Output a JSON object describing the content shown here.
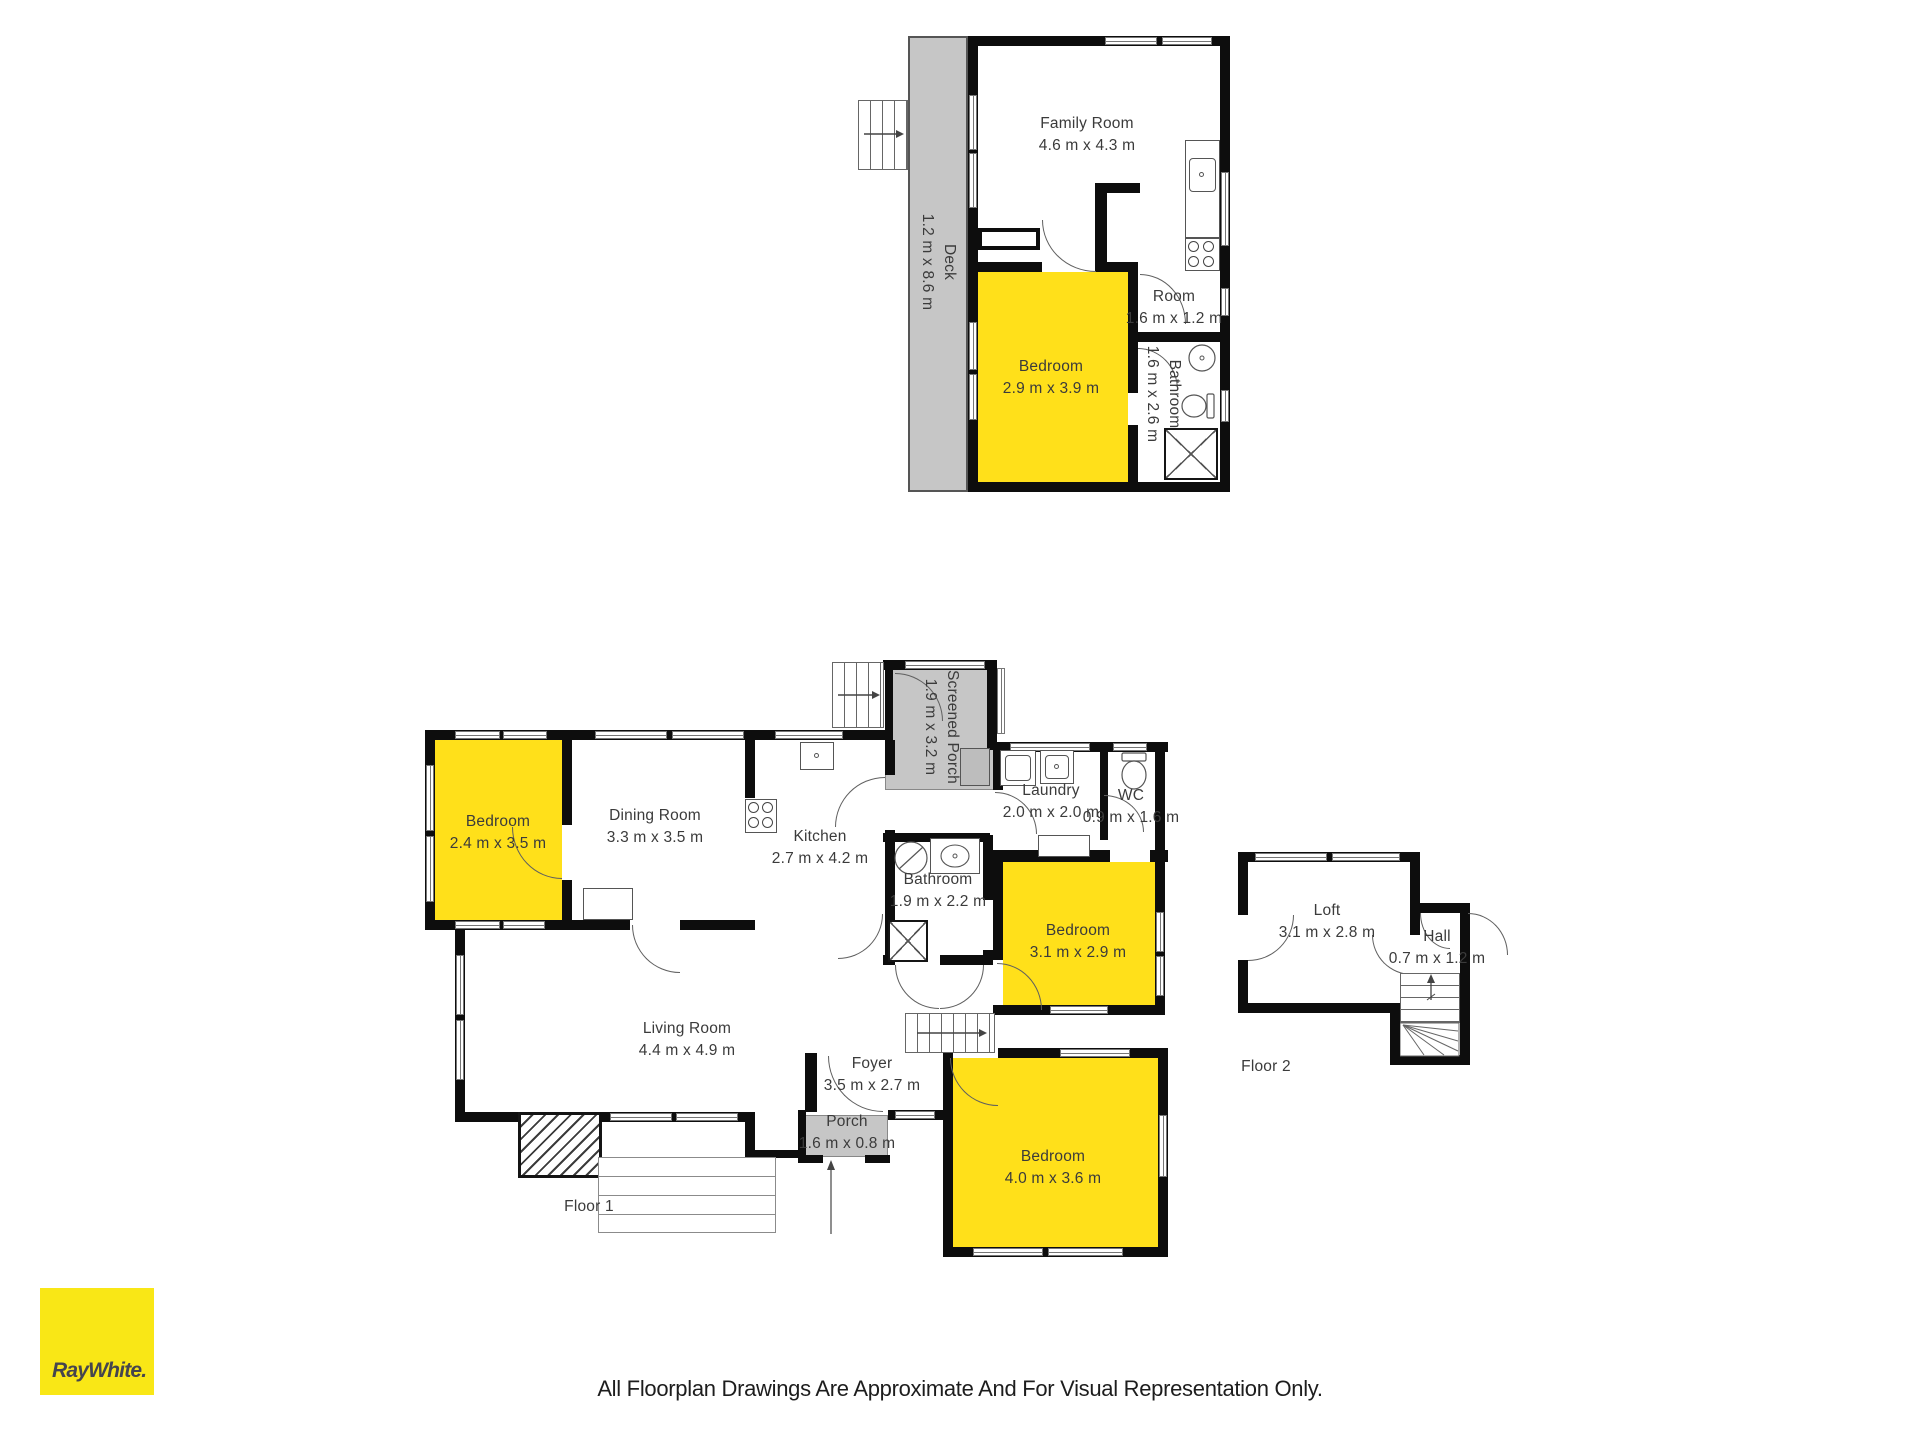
{
  "rooms": {
    "f3_family": {
      "name": "Family Room",
      "dims": "4.6 m x 4.3 m"
    },
    "f3_deck": {
      "name": "Deck",
      "dims": "1.2 m x 8.6 m"
    },
    "f3_bedroom": {
      "name": "Bedroom",
      "dims": "2.9 m x 3.9 m"
    },
    "f3_room": {
      "name": "Room",
      "dims": "1.6 m x 1.2 m"
    },
    "f3_bath": {
      "name": "Bathroom",
      "dims": "1.6 m x 2.6 m"
    },
    "f1_bedroom_left": {
      "name": "Bedroom",
      "dims": "2.4 m x 3.5 m"
    },
    "f1_dining": {
      "name": "Dining Room",
      "dims": "3.3 m x 3.5 m"
    },
    "f1_kitchen": {
      "name": "Kitchen",
      "dims": "2.7 m x 4.2 m"
    },
    "f1_screened_porch": {
      "name": "Screened Porch",
      "dims": "1.9 m x 3.2 m"
    },
    "f1_laundry": {
      "name": "Laundry",
      "dims": "2.0 m x 2.0 m"
    },
    "f1_wc": {
      "name": "WC",
      "dims": "0.9 m x 1.6 m"
    },
    "f1_bath": {
      "name": "Bathroom",
      "dims": "1.9 m x 2.2 m"
    },
    "f1_bedroom_mid": {
      "name": "Bedroom",
      "dims": "3.1 m x 2.9 m"
    },
    "f1_living": {
      "name": "Living Room",
      "dims": "4.4 m x 4.9 m"
    },
    "f1_foyer": {
      "name": "Foyer",
      "dims": "3.5 m x 2.7 m"
    },
    "f1_porch": {
      "name": "Porch",
      "dims": "1.6 m x 0.8 m"
    },
    "f1_bedroom_bottom": {
      "name": "Bedroom",
      "dims": "4.0 m x 3.6 m"
    },
    "f2_loft": {
      "name": "Loft",
      "dims": "3.1 m x 2.8 m"
    },
    "f2_hall": {
      "name": "Hall",
      "dims": "0.7 m x 1.2 m"
    }
  },
  "floor_labels": {
    "floor1": "Floor 1",
    "floor2": "Floor 2"
  },
  "branding": {
    "logo_text": "RayWhite."
  },
  "footer": {
    "disclaimer": "All Floorplan Drawings Are Approximate And For Visual Representation Only."
  },
  "colors": {
    "highlight": "#FFE01A",
    "area_gray": "#C6C6C6",
    "wall": "#0D0D0D",
    "brand_yellow": "#F9E716",
    "brand_text": "#45454E"
  }
}
